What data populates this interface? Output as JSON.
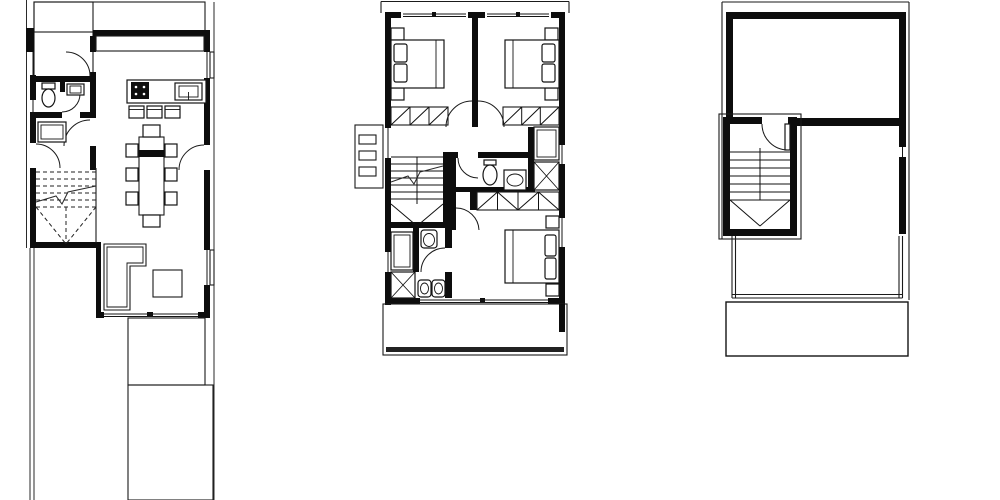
{
  "document": {
    "kind": "architectural-floor-plan-sheet",
    "sheet_background": "#ffffff",
    "palette": {
      "wall": "#0d0d0d",
      "line": "#1a1a1a",
      "hatch_grid": "#161616",
      "deck_stripe": "#3a3a3a",
      "table_hatch": "#6b6b6b",
      "background": "#ffffff"
    }
  },
  "plans": [
    {
      "id": "ground-floor-plan",
      "position": "left",
      "features": [
        "property-boundary-lines",
        "tiled-patio-grid",
        "entry-door",
        "hall-door",
        "wc-toilet",
        "wc-sink",
        "storage-closet",
        "dashed-staircase",
        "kitchen-counter",
        "kitchen-island",
        "cooktop",
        "kitchen-sink",
        "bar-stools",
        "dining-table",
        "dining-chairs",
        "terrace-door",
        "l-shaped-sofa",
        "rug",
        "window-openings",
        "sliding-glass-door",
        "timber-deck"
      ]
    },
    {
      "id": "first-floor-plan",
      "position": "center",
      "features": [
        "parapet-outline",
        "bedroom-1-bed",
        "bedroom-2-bed",
        "nightstands",
        "pillows",
        "wardrobe-runs",
        "hall-door-swings",
        "staircase",
        "break-line",
        "bathroom-toilet",
        "bathroom-sink",
        "built-in-closet",
        "shower-box",
        "en-suite-toilet",
        "en-suite-shower",
        "double-sinks",
        "linen-closet",
        "master-bed",
        "balcony-rail",
        "ac-louvre-unit",
        "window-openings"
      ]
    },
    {
      "id": "roof-plan",
      "position": "right",
      "features": [
        "roof-edge-outline",
        "perimeter-walls",
        "stair-bulkhead",
        "bulkhead-door",
        "stair-flight",
        "winder-treads",
        "roof-terrace-railing",
        "lower-canopy-slab"
      ]
    }
  ]
}
